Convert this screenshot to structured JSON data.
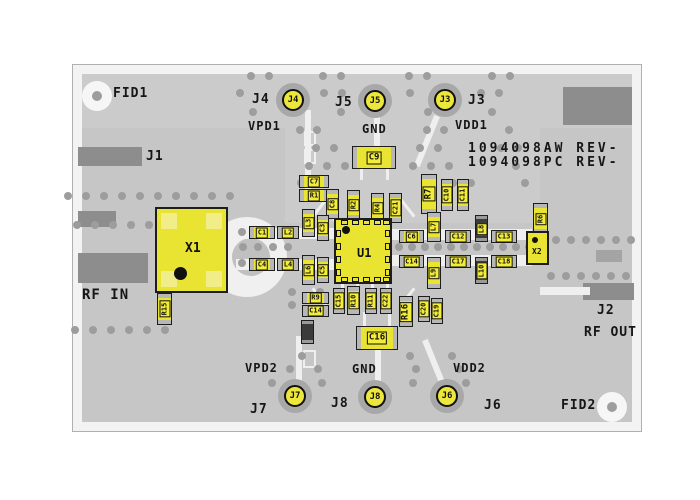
{
  "title": "RF evaluation board PCB top view",
  "board": {
    "part_numbers": [
      "1094098AW REV-",
      "1094098PC REV-"
    ],
    "colors": {
      "board_gray": "#c6c6c6",
      "edge_white": "#f3f3f3",
      "dark_block": "#8d8d8d",
      "trace_white": "#efefef",
      "component_yellow": "#e9e432",
      "label_yellow": "#f2ec3a",
      "silk_black": "#161616",
      "via_gray": "#9d9d9d"
    }
  },
  "silkscreen": [
    {
      "id": "fid1",
      "text": "FID1",
      "x": 113,
      "y": 86,
      "size": 13
    },
    {
      "id": "j4-label",
      "text": "J4",
      "x": 252,
      "y": 92,
      "size": 13
    },
    {
      "id": "vpd1",
      "text": "VPD1",
      "x": 248,
      "y": 119,
      "size": 12
    },
    {
      "id": "j5-label",
      "text": "J5",
      "x": 335,
      "y": 95,
      "size": 13
    },
    {
      "id": "gnd-top",
      "text": "GND",
      "x": 362,
      "y": 122,
      "size": 12
    },
    {
      "id": "j3-label",
      "text": "J3",
      "x": 468,
      "y": 93,
      "size": 13
    },
    {
      "id": "vdd1",
      "text": "VDD1",
      "x": 455,
      "y": 118,
      "size": 12
    },
    {
      "id": "part-number-1",
      "text": "1094098AW REV-",
      "x": 468,
      "y": 141,
      "size": 13,
      "spacing": 3
    },
    {
      "id": "part-number-2",
      "text": "1094098PC REV-",
      "x": 468,
      "y": 155,
      "size": 13,
      "spacing": 3
    },
    {
      "id": "j1-label",
      "text": "J1",
      "x": 146,
      "y": 149,
      "size": 13
    },
    {
      "id": "rf-in",
      "text": "RF IN",
      "x": 82,
      "y": 287,
      "size": 14
    },
    {
      "id": "j2-label",
      "text": "J2",
      "x": 597,
      "y": 303,
      "size": 13
    },
    {
      "id": "rf-out",
      "text": "RF OUT",
      "x": 584,
      "y": 325,
      "size": 13
    },
    {
      "id": "fid2",
      "text": "FID2",
      "x": 561,
      "y": 398,
      "size": 13
    },
    {
      "id": "vpd2",
      "text": "VPD2",
      "x": 245,
      "y": 361,
      "size": 12
    },
    {
      "id": "j7-label",
      "text": "J7",
      "x": 250,
      "y": 402,
      "size": 13
    },
    {
      "id": "j8-label",
      "text": "J8",
      "x": 331,
      "y": 396,
      "size": 13
    },
    {
      "id": "gnd-bottom",
      "text": "GND",
      "x": 352,
      "y": 362,
      "size": 12
    },
    {
      "id": "vdd2",
      "text": "VDD2",
      "x": 453,
      "y": 361,
      "size": 12
    },
    {
      "id": "j6-label",
      "text": "J6",
      "x": 484,
      "y": 398,
      "size": 13
    }
  ],
  "pads": [
    {
      "id": "J4",
      "x": 293,
      "y": 100
    },
    {
      "id": "J5",
      "x": 375,
      "y": 101
    },
    {
      "id": "J3",
      "x": 445,
      "y": 100
    },
    {
      "id": "J7",
      "x": 295,
      "y": 396
    },
    {
      "id": "J8",
      "x": 375,
      "y": 397
    },
    {
      "id": "J6",
      "x": 447,
      "y": 396
    }
  ],
  "fiducial_pads": [
    {
      "id": "FID1",
      "x": 97,
      "y": 96
    },
    {
      "id": "FID2",
      "x": 612,
      "y": 407
    }
  ],
  "ics": [
    {
      "ref": "X1",
      "x": 155,
      "y": 207,
      "w": 73,
      "h": 86,
      "fs": 13,
      "lx": 28,
      "ly": 32,
      "dx": 17,
      "dy": 58,
      "dr": 13,
      "corners": true
    },
    {
      "ref": "U1",
      "x": 334,
      "y": 218,
      "w": 58,
      "h": 66,
      "fs": 12,
      "lx": 21,
      "ly": 26,
      "dx": 6,
      "dy": 6,
      "dr": 8,
      "pins": true
    },
    {
      "ref": "X2",
      "x": 526,
      "y": 231,
      "w": 23,
      "h": 34,
      "fs": 8,
      "lx": 4,
      "ly": 14,
      "dx": 4,
      "dy": 4,
      "dr": 6
    }
  ],
  "components": [
    {
      "ref": "C9",
      "x": 352,
      "y": 146,
      "w": 44,
      "h": 23,
      "o": "h",
      "big": true
    },
    {
      "ref": "C7",
      "x": 299,
      "y": 175,
      "w": 30,
      "h": 13,
      "o": "h"
    },
    {
      "ref": "R1",
      "x": 299,
      "y": 189,
      "w": 30,
      "h": 13,
      "o": "h"
    },
    {
      "ref": "C8",
      "x": 326,
      "y": 189,
      "w": 13,
      "h": 30,
      "o": "v"
    },
    {
      "ref": "R2",
      "x": 347,
      "y": 190,
      "w": 13,
      "h": 30,
      "o": "v"
    },
    {
      "ref": "R4",
      "x": 371,
      "y": 193,
      "w": 13,
      "h": 30,
      "o": "v"
    },
    {
      "ref": "C21",
      "x": 389,
      "y": 193,
      "w": 13,
      "h": 30,
      "o": "v"
    },
    {
      "ref": "R7",
      "x": 421,
      "y": 174,
      "w": 16,
      "h": 40,
      "o": "v",
      "big": true
    },
    {
      "ref": "C10",
      "x": 441,
      "y": 179,
      "w": 12,
      "h": 32,
      "o": "v"
    },
    {
      "ref": "C11",
      "x": 457,
      "y": 179,
      "w": 12,
      "h": 32,
      "o": "v"
    },
    {
      "ref": "C1",
      "x": 249,
      "y": 226,
      "w": 26,
      "h": 13,
      "o": "h"
    },
    {
      "ref": "L2",
      "x": 277,
      "y": 226,
      "w": 22,
      "h": 13,
      "o": "h"
    },
    {
      "ref": "L3",
      "x": 302,
      "y": 209,
      "w": 13,
      "h": 28,
      "o": "v"
    },
    {
      "ref": "C3",
      "x": 317,
      "y": 215,
      "w": 12,
      "h": 26,
      "o": "v"
    },
    {
      "ref": "C4",
      "x": 249,
      "y": 258,
      "w": 26,
      "h": 13,
      "o": "h"
    },
    {
      "ref": "L4",
      "x": 277,
      "y": 258,
      "w": 22,
      "h": 13,
      "o": "h"
    },
    {
      "ref": "L6",
      "x": 302,
      "y": 255,
      "w": 13,
      "h": 30,
      "o": "v"
    },
    {
      "ref": "C5",
      "x": 317,
      "y": 257,
      "w": 12,
      "h": 26,
      "o": "v"
    },
    {
      "ref": "C6",
      "x": 399,
      "y": 230,
      "w": 25,
      "h": 13,
      "o": "h"
    },
    {
      "ref": "L7",
      "x": 427,
      "y": 212,
      "w": 14,
      "h": 30,
      "o": "v"
    },
    {
      "ref": "C12",
      "x": 445,
      "y": 230,
      "w": 26,
      "h": 13,
      "o": "h"
    },
    {
      "ref": "L8",
      "x": 475,
      "y": 215,
      "w": 13,
      "h": 27,
      "o": "v",
      "dark": true
    },
    {
      "ref": "C13",
      "x": 491,
      "y": 230,
      "w": 26,
      "h": 13,
      "o": "h"
    },
    {
      "ref": "C14",
      "x": 399,
      "y": 255,
      "w": 25,
      "h": 13,
      "o": "h"
    },
    {
      "ref": "L9",
      "x": 427,
      "y": 257,
      "w": 14,
      "h": 32,
      "o": "v"
    },
    {
      "ref": "C17",
      "x": 445,
      "y": 255,
      "w": 26,
      "h": 13,
      "o": "h"
    },
    {
      "ref": "L10",
      "x": 475,
      "y": 257,
      "w": 13,
      "h": 27,
      "o": "v",
      "dark": true
    },
    {
      "ref": "C18",
      "x": 491,
      "y": 255,
      "w": 26,
      "h": 13,
      "o": "h"
    },
    {
      "ref": "R9",
      "x": 302,
      "y": 292,
      "w": 27,
      "h": 12,
      "o": "h"
    },
    {
      "ref": "C14",
      "x": 302,
      "y": 305,
      "w": 27,
      "h": 12,
      "o": "h"
    },
    {
      "ref": "",
      "x": 301,
      "y": 320,
      "w": 13,
      "h": 24,
      "o": "v",
      "dark": true
    },
    {
      "ref": "C15",
      "x": 333,
      "y": 288,
      "w": 12,
      "h": 26,
      "o": "v"
    },
    {
      "ref": "R10",
      "x": 347,
      "y": 286,
      "w": 13,
      "h": 29,
      "o": "v"
    },
    {
      "ref": "R11",
      "x": 365,
      "y": 288,
      "w": 12,
      "h": 26,
      "o": "v"
    },
    {
      "ref": "C22",
      "x": 380,
      "y": 288,
      "w": 12,
      "h": 26,
      "o": "v"
    },
    {
      "ref": "R16",
      "x": 399,
      "y": 296,
      "w": 14,
      "h": 31,
      "o": "v",
      "big": true
    },
    {
      "ref": "C20",
      "x": 418,
      "y": 296,
      "w": 12,
      "h": 26,
      "o": "v"
    },
    {
      "ref": "C19",
      "x": 431,
      "y": 298,
      "w": 12,
      "h": 26,
      "o": "v"
    },
    {
      "ref": "C16",
      "x": 356,
      "y": 326,
      "w": 42,
      "h": 24,
      "o": "h",
      "big": true
    },
    {
      "ref": "R15",
      "x": 157,
      "y": 293,
      "w": 15,
      "h": 32,
      "o": "v"
    },
    {
      "ref": "R6",
      "x": 533,
      "y": 203,
      "w": 15,
      "h": 31,
      "o": "v"
    }
  ],
  "dark_blocks": [
    {
      "x": 563,
      "y": 87,
      "w": 69,
      "h": 38
    },
    {
      "x": 78,
      "y": 147,
      "w": 64,
      "h": 19
    },
    {
      "x": 78,
      "y": 211,
      "w": 38,
      "h": 16
    },
    {
      "x": 78,
      "y": 253,
      "w": 70,
      "h": 30
    },
    {
      "x": 583,
      "y": 283,
      "w": 51,
      "h": 17
    },
    {
      "x": 596,
      "y": 250,
      "w": 26,
      "h": 12,
      "c": "#a4a4a4"
    }
  ]
}
